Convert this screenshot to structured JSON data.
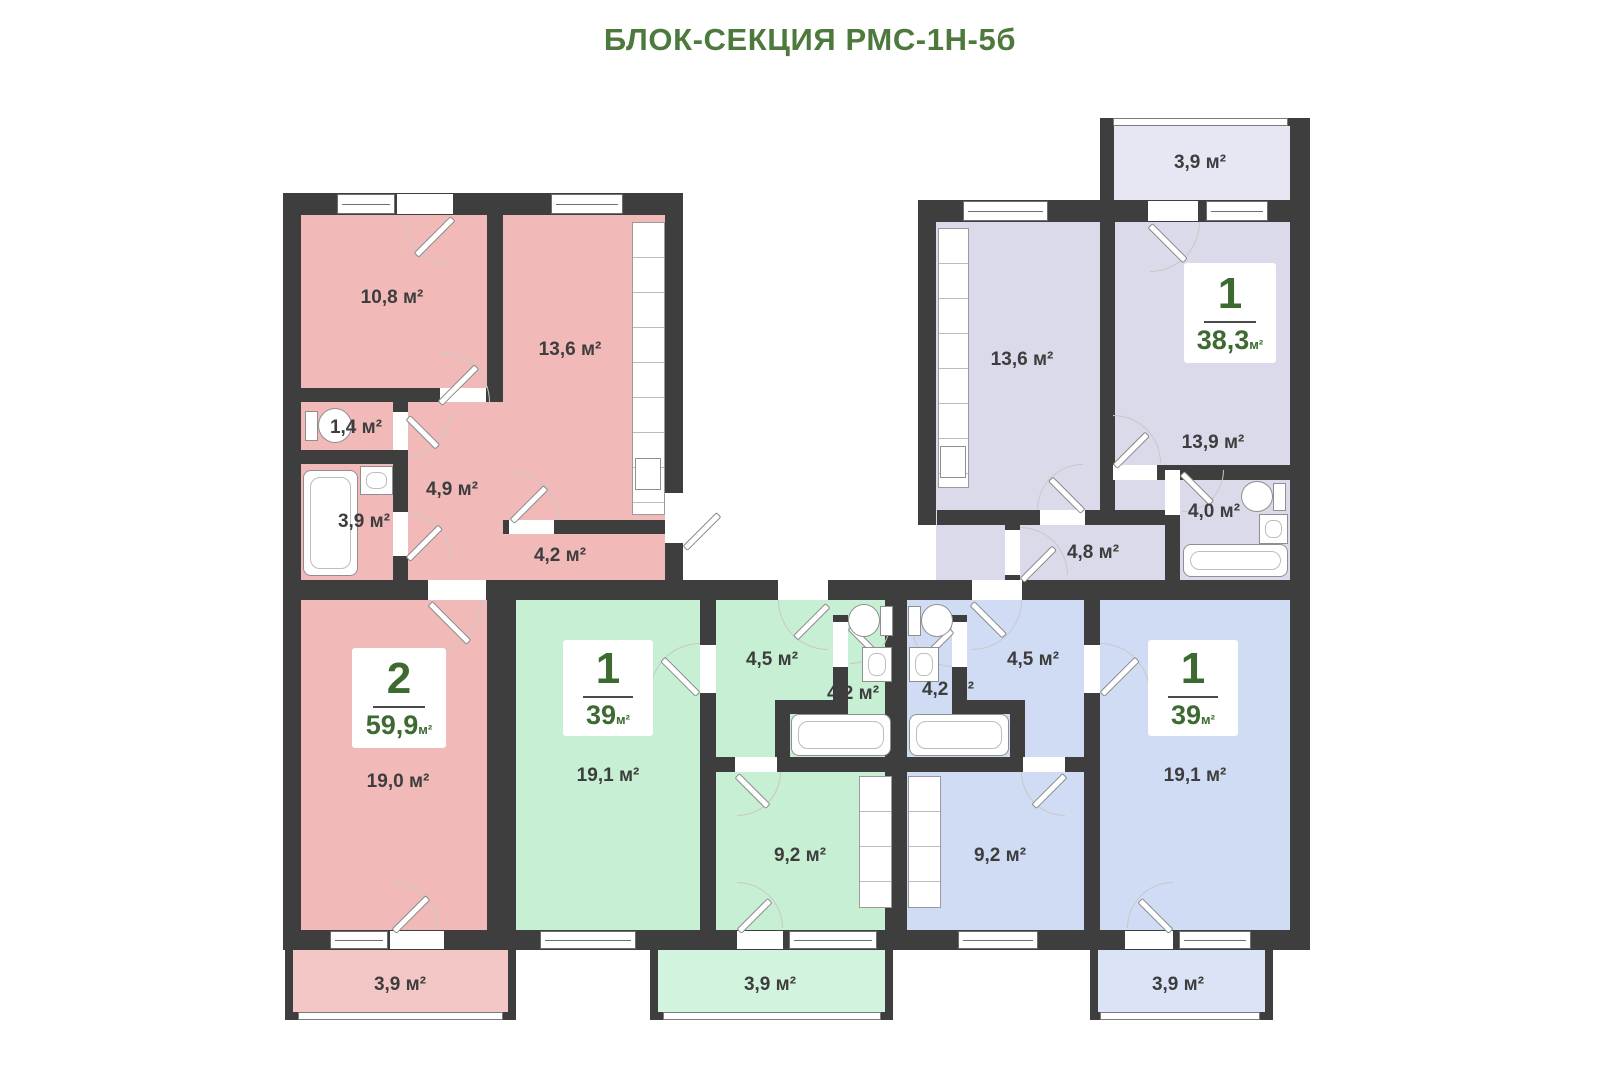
{
  "title": "БЛОК-СЕКЦИЯ РМС-1Н-5б",
  "colors": {
    "title": "#4d7a3c",
    "wall": "#3e3e3e",
    "card_text": "#3c6a31",
    "room_label": "#3d3d3d",
    "pink": "#f2b9b9",
    "pink_light": "#f4c7c7",
    "green": "#c7efd4",
    "green_light": "#d2f3dd",
    "blue": "#cfdcf3",
    "blue_light": "#dbe4f7",
    "lavender": "#dadaeb",
    "lavender_light": "#e7e7f4"
  },
  "apartments": {
    "left_2room": {
      "card": {
        "rooms_count": "2",
        "area_value": "59,9",
        "area_unit": "м²"
      },
      "rooms": {
        "bedroom_small": "10,8 м²",
        "kitchen_living": "13,6 м²",
        "wc": "1,4 м²",
        "hallway": "4,9 м²",
        "bathroom": "3,9 м²",
        "corridor": "4,2 м²",
        "living_room": "19,0 м²",
        "balcony": "3,9 м²"
      }
    },
    "center_green_1room": {
      "card": {
        "rooms_count": "1",
        "area_value": "39",
        "area_unit": "м²"
      },
      "rooms": {
        "living_room": "19,1 м²",
        "hallway": "4,5 м²",
        "bathroom": "4,2 м²",
        "kitchen": "9,2 м²",
        "balcony": "3,9 м²"
      }
    },
    "center_blue_1room": {
      "card": {
        "rooms_count": "1",
        "area_value": "39",
        "area_unit": "м²"
      },
      "rooms": {
        "living_room": "19,1 м²",
        "hallway": "4,5 м²",
        "bathroom": "4,2 м²",
        "kitchen": "9,2 м²",
        "balcony": "3,9 м²"
      }
    },
    "top_right_1room": {
      "card": {
        "rooms_count": "1",
        "area_value": "38,3",
        "area_unit": "м²"
      },
      "rooms": {
        "kitchen": "13,6 м²",
        "living_room": "13,9 м²",
        "bathroom": "4,0 м²",
        "hallway": "4,8 м²",
        "balcony": "3,9 м²"
      }
    }
  }
}
